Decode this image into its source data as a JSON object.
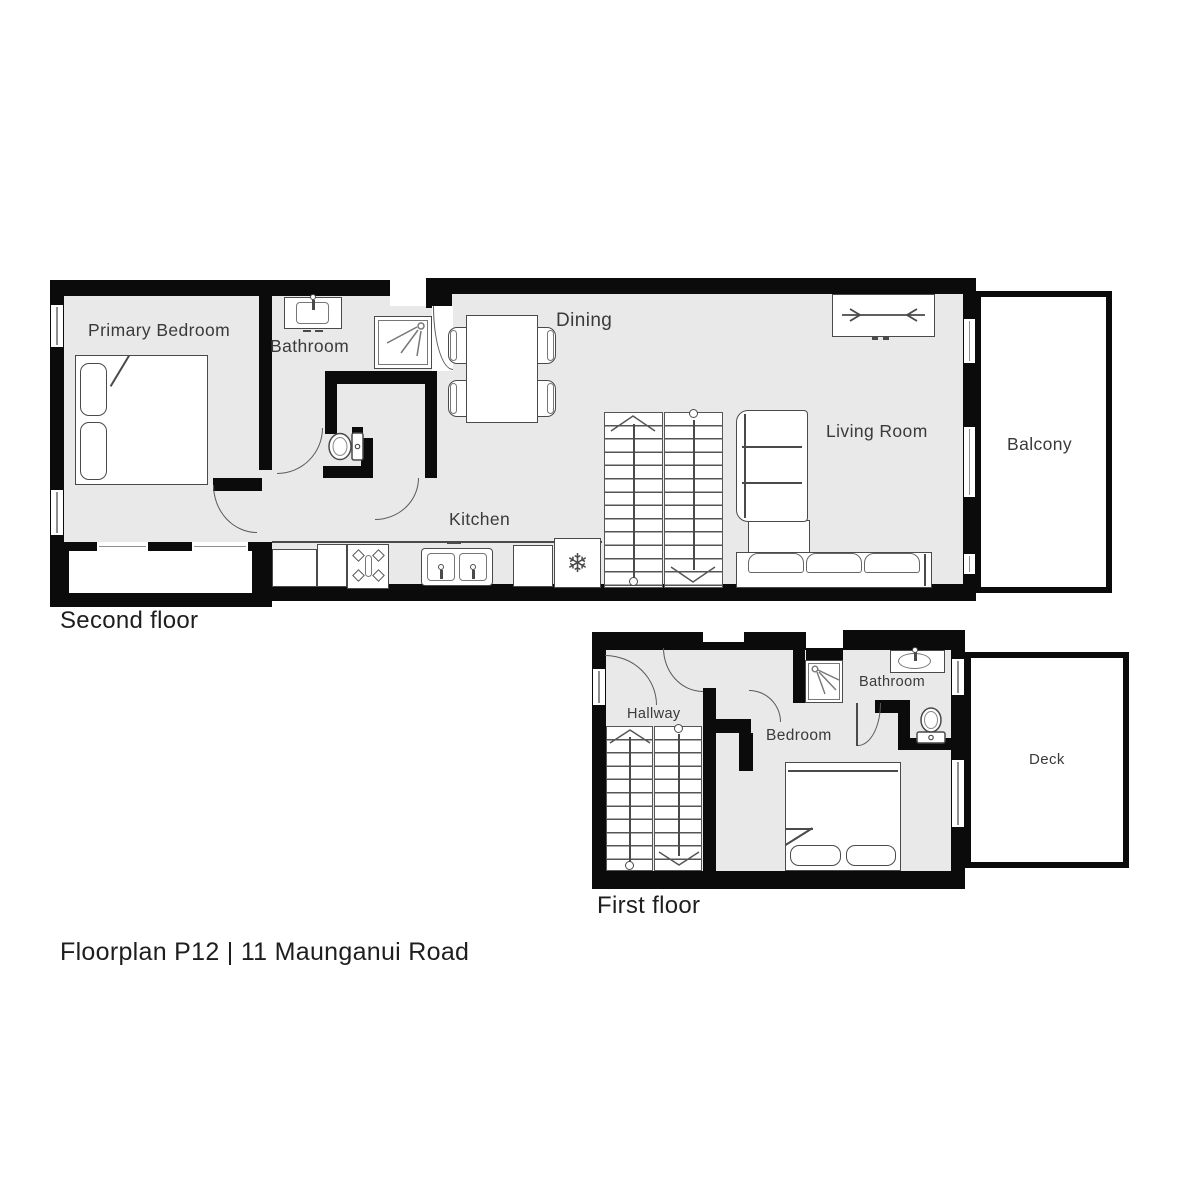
{
  "floors": {
    "second": {
      "label": "Second floor",
      "rooms": {
        "primary_bedroom": "Primary Bedroom",
        "bathroom": "Bathroom",
        "dining": "Dining",
        "kitchen": "Kitchen",
        "living_room": "Living Room",
        "balcony": "Balcony"
      }
    },
    "first": {
      "label": "First floor",
      "rooms": {
        "hallway": "Hallway",
        "bedroom": "Bedroom",
        "bathroom": "Bathroom",
        "deck": "Deck"
      }
    }
  },
  "footer": {
    "title": "Floorplan P12 | 11 Maunganui Road"
  },
  "icons": {
    "fridge_glyph": "❄"
  },
  "colors": {
    "wall": "#0b0b0b",
    "room_fill": "#e9e9e9",
    "outdoor_fill": "#ffffff",
    "furniture_stroke": "#4a4a4a",
    "label_color": "#3a3a3a",
    "title_color": "#1e1e1e"
  }
}
